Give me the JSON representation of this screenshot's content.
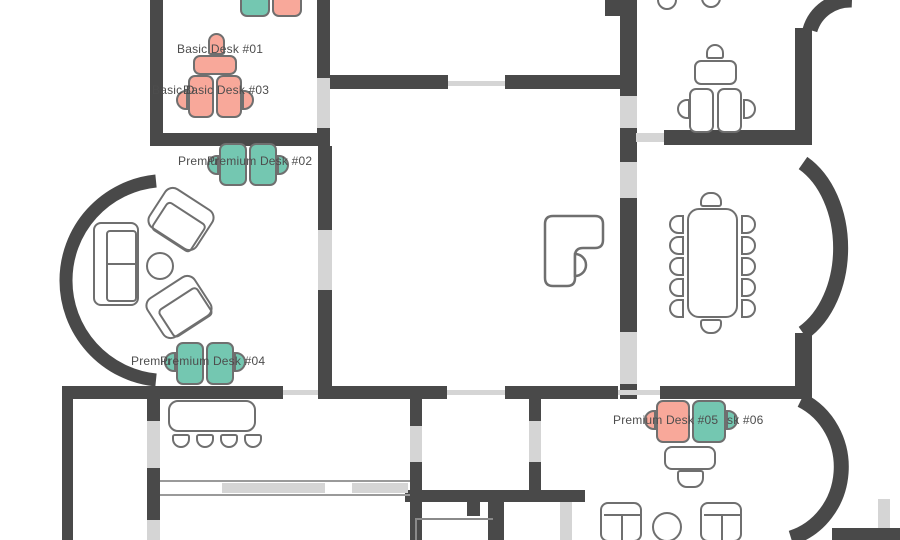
{
  "view": {
    "name": "office-floor-plan",
    "description_visible": "Floor plan with bookable desks, meeting room and lounges"
  },
  "colors": {
    "wall": "#494949",
    "window": "#d5d5d5",
    "outline": "#6f6f6f",
    "occupied": "#f8a89a",
    "available": "#74c7b1",
    "labeltext": "#4d4d4d"
  },
  "labels": {
    "top_a": "Basic D",
    "top_b": "Basic Desk #",
    "basic_01": "Basic Desk #01",
    "basic_03_frag": "Basic D",
    "basic_03": "Basic Desk #03",
    "premium_02_frag": "Premiu",
    "premium_02": "Premium Desk #02",
    "premium_04_frag": "Premiu",
    "premium_04": "Premium Desk #04",
    "premium_05": "Premium Desk #05",
    "premium_06_frag": "sk #06"
  },
  "desks": [
    {
      "id": "top-pair-left",
      "status_color": "#74c7b1"
    },
    {
      "id": "top-pair-right",
      "status_color": "#f8a89a"
    },
    {
      "id": "basic-01",
      "status_color": "#f8a89a"
    },
    {
      "id": "basic-03-left",
      "status_color": "#f8a89a"
    },
    {
      "id": "basic-03-right",
      "status_color": "#f8a89a"
    },
    {
      "id": "premium-02-left",
      "status_color": "#74c7b1"
    },
    {
      "id": "premium-02-right",
      "status_color": "#74c7b1"
    },
    {
      "id": "premium-04-left",
      "status_color": "#74c7b1"
    },
    {
      "id": "premium-04-right",
      "status_color": "#74c7b1"
    },
    {
      "id": "premium-05",
      "status_color": "#f8a89a"
    },
    {
      "id": "premium-06",
      "status_color": "#74c7b1"
    }
  ]
}
